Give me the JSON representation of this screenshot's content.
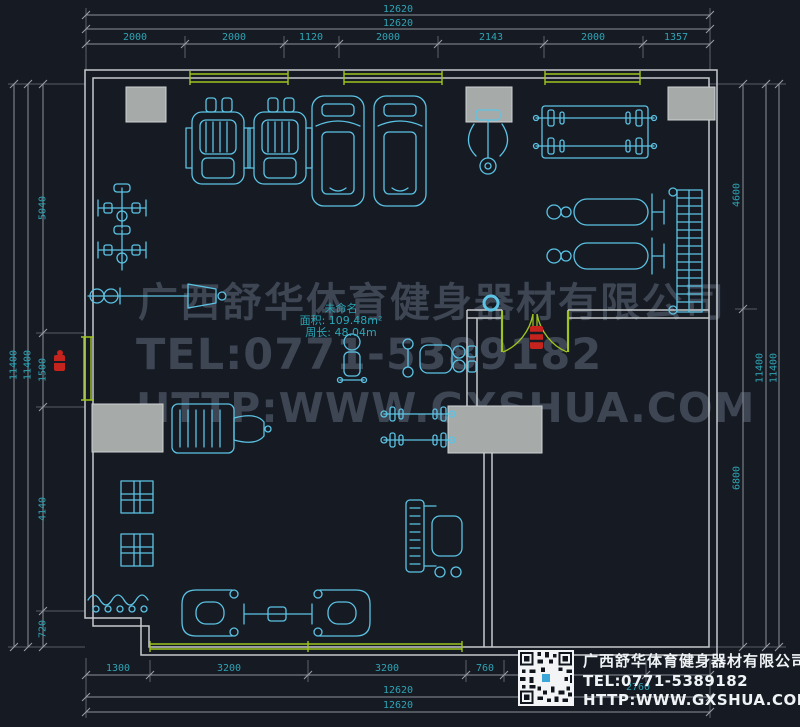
{
  "drawing": {
    "type": "cad-floor-plan",
    "room_label": {
      "name": "未命名",
      "area": "面积: 109.48m²",
      "perimeter": "周长: 48.04m"
    },
    "colors": {
      "background": "#151a23",
      "wall": "#c6cacc",
      "equipment": "#5cc3e4",
      "window_door": "#9fc41f",
      "dimension_text": "#2fa3b3",
      "dimension_line": "#8a9099",
      "alarm_red": "#c4241d",
      "column_gray": "#a6aaa9",
      "watermark": "#3e4654"
    },
    "equipment_icons": [
      "massage-chair-icon",
      "treadmill-icon",
      "pec-deck-icon",
      "smith-machine-icon",
      "dumbbell-bench-icon",
      "plate-rack-icon",
      "cable-machine-icon",
      "bench-press-icon",
      "kettlebell-stand-icon",
      "seated-row-icon",
      "press-machine-icon",
      "barbell-rack-icon",
      "squat-machine-icon",
      "curl-rack-icon",
      "bench-icon",
      "barbell-icon",
      "window-symbol",
      "column-circle-icon"
    ]
  },
  "dimensions": {
    "top": {
      "total_outer": "12620",
      "total_inner": "12620",
      "segments": [
        "2000",
        "2000",
        "1120",
        "2000",
        "2143",
        "2000",
        "1357"
      ]
    },
    "left": {
      "total_outer": "11400",
      "total_inner": "11400",
      "segments": [
        "5040",
        "1500",
        "4140",
        "720"
      ]
    },
    "right": {
      "segments": [
        "4600",
        "6800"
      ],
      "total_inner": "11400",
      "total_outer": "11400"
    },
    "bottom": {
      "segments": [
        "1300",
        "3200",
        "3200",
        "760",
        "2760"
      ],
      "total_inner": "12620",
      "total_outer": "12620"
    }
  },
  "watermark": {
    "line1": "广西舒华体育健身器材有限公司",
    "line2": "TEL:0771-5389182",
    "line3": "HTTP:WWW.GXSHUA.COM"
  },
  "logo_card": {
    "company": "广西舒华体育健身器材有限公司",
    "tel": "TEL:0771-5389182",
    "url": "HTTP:WWW.GXSHUA.COM"
  }
}
